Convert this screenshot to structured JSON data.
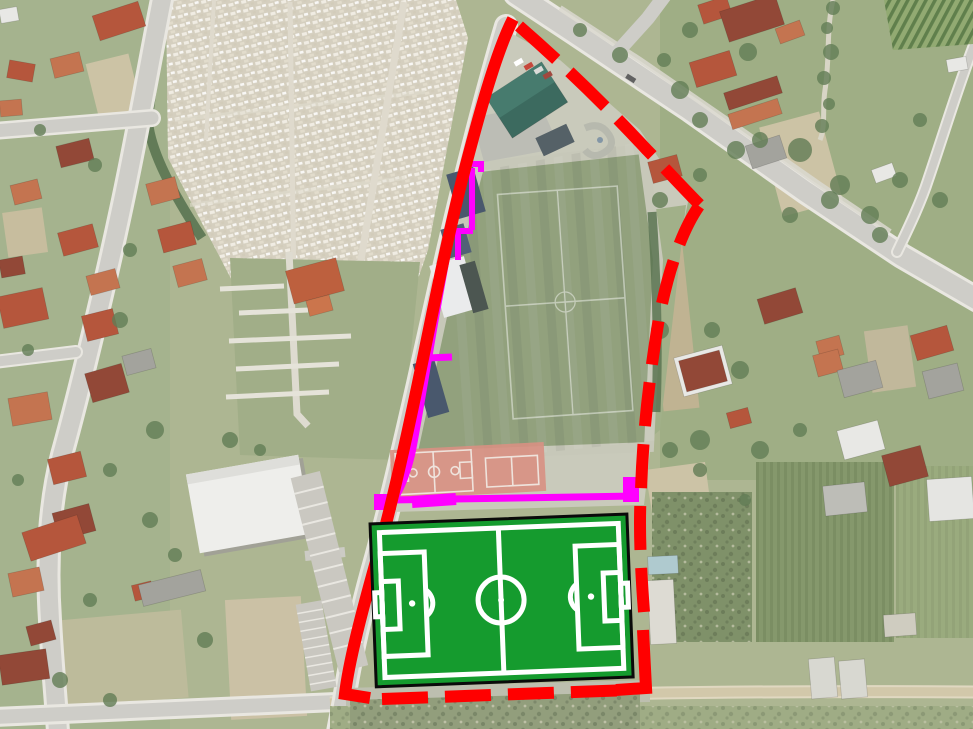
{
  "theme": {
    "boundary-color": "#ff0000",
    "service-line-color": "#ff00ff",
    "pitch-green": "#159b2e",
    "pitch-line": "#ffffff",
    "pitch-border": "#0a0a0a",
    "stadium-grass": "#8a9a74",
    "court-clay": "#d6897a",
    "road-fill": "#cbcac4",
    "road-casing": "#e8e6df",
    "dirt-road": "#cfc4a4",
    "cemetery-base": "#d2ccbb",
    "field-green": "#a7b18a"
  },
  "annotations": {
    "boundary_color": "#ff0000",
    "service_line_color": "#ff00ff",
    "planned_pitch_fill": "#159b2e",
    "planned_pitch_line": "#ffffff"
  }
}
